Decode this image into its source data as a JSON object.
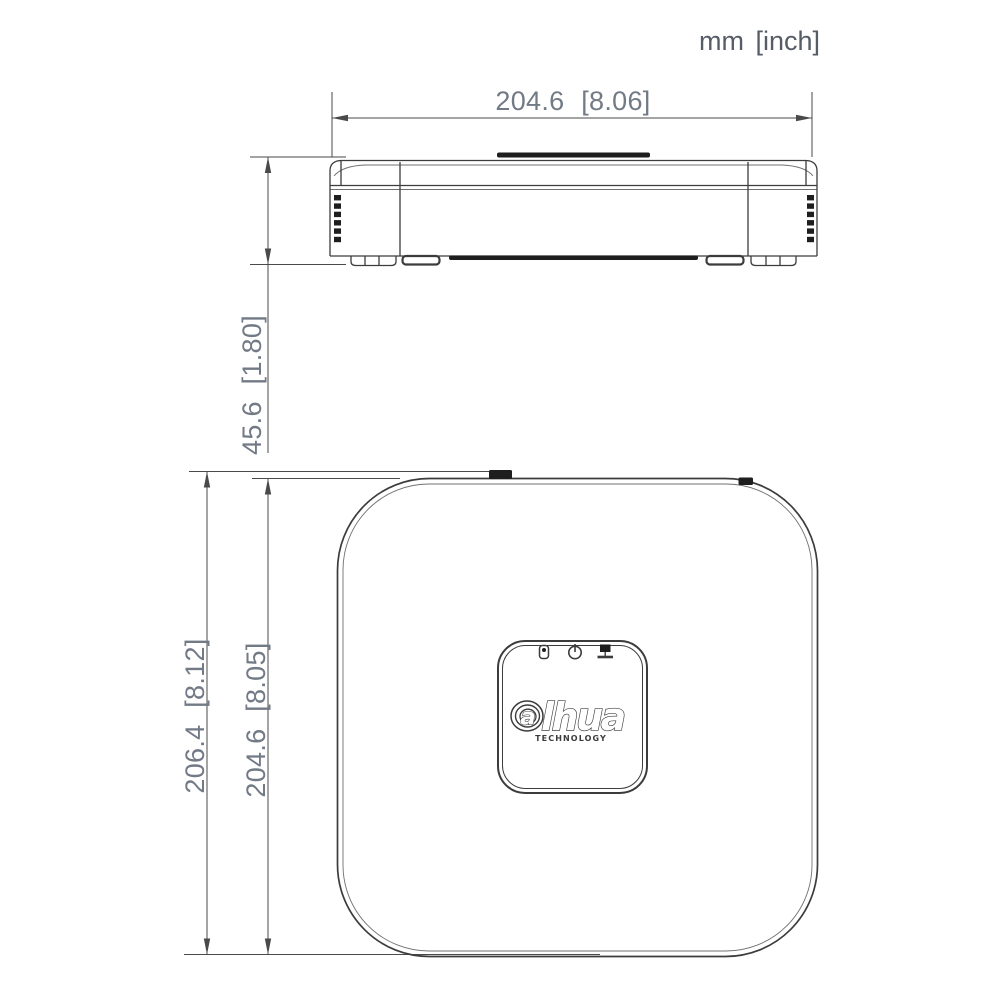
{
  "drawing": {
    "units_label": "mm [inch]",
    "front_view": {
      "view_name": "front-elevation",
      "width_dim_label": "204.6 [8.06]",
      "height_dim_label": "45.6 [1.80]"
    },
    "top_view": {
      "view_name": "top-plan",
      "overall_depth_dim_label": "206.4 [8.12]",
      "body_depth_dim_label": "204.6 [8.05]",
      "panel": {
        "indicator_icons": [
          "hdd-icon",
          "power-icon",
          "network-icon"
        ],
        "logo_first_letter": "a",
        "logo_rest": "lhua",
        "logo_subtitle": "TECHNOLOGY"
      }
    },
    "colors": {
      "background": "#ffffff",
      "line": "#3c3c3c",
      "inner_line": "#707070",
      "dim_line": "#4a4a4a",
      "dim_text": "#727a86",
      "units_text": "#565d66",
      "dark_fill": "#1e1e1e"
    }
  }
}
